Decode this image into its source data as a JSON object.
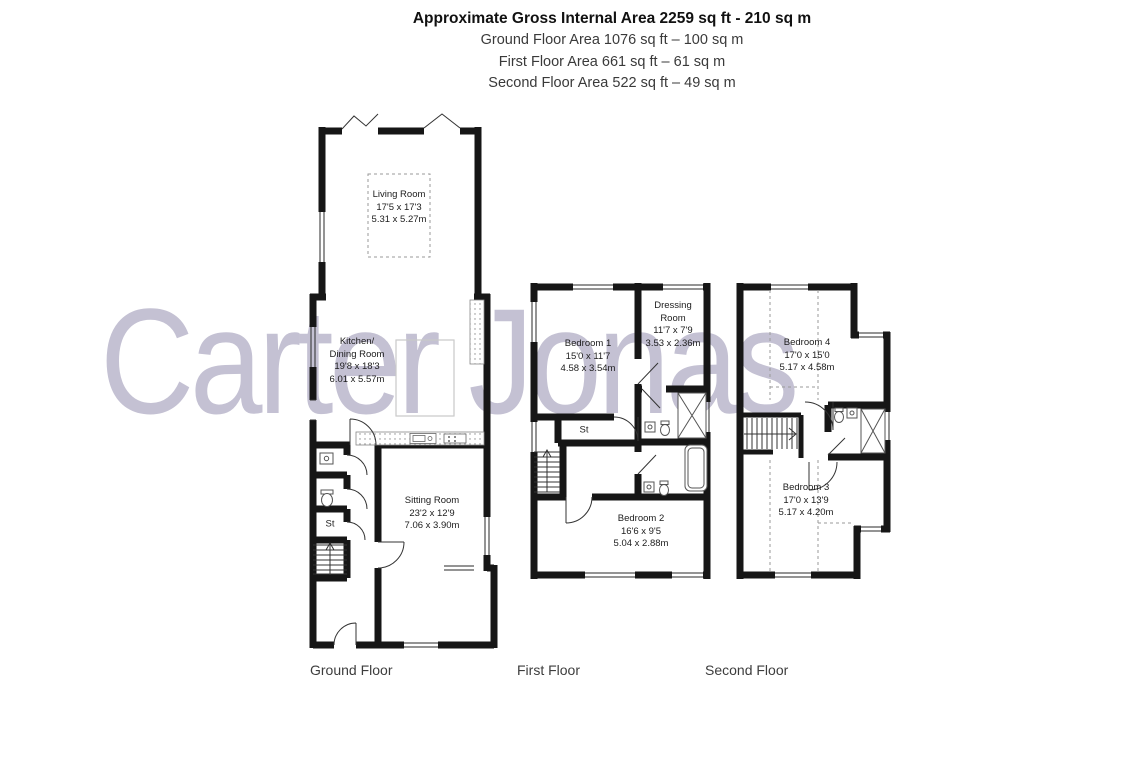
{
  "header": {
    "title": "Approximate Gross Internal Area 2259 sq ft - 210 sq m",
    "ground_line": "Ground Floor Area 1076 sq ft – 100 sq m",
    "first_line": "First Floor Area 661 sq ft – 61 sq m",
    "second_line": "Second Floor Area 522 sq ft – 49 sq m"
  },
  "watermark": {
    "text": "Carter Jonas",
    "color": "#c4c1d3"
  },
  "floors": {
    "ground": {
      "label": "Ground Floor",
      "rooms": {
        "living": {
          "name": "Living Room",
          "imperial": "17'5 x 17'3",
          "metric": "5.31 x 5.27m"
        },
        "kitchen": {
          "name": "Kitchen/",
          "name2": "Dining Room",
          "imperial": "19'8 x 18'3",
          "metric": "6.01 x 5.57m"
        },
        "sitting": {
          "name": "Sitting Room",
          "imperial": "23'2 x 12'9",
          "metric": "7.06 x 3.90m"
        },
        "store": {
          "name": "St"
        }
      }
    },
    "first": {
      "label": "First Floor",
      "rooms": {
        "bedroom1": {
          "name": "Bedroom 1",
          "imperial": "15'0 x 11'7",
          "metric": "4.58 x 3.54m"
        },
        "dressing": {
          "name": "Dressing",
          "name2": "Room",
          "imperial": "11'7 x 7'9",
          "metric": "3.53 x 2.36m"
        },
        "bedroom2": {
          "name": "Bedroom 2",
          "imperial": "16'6 x 9'5",
          "metric": "5.04 x 2.88m"
        },
        "store": {
          "name": "St"
        }
      }
    },
    "second": {
      "label": "Second Floor",
      "rooms": {
        "bedroom4": {
          "name": "Bedroom 4",
          "imperial": "17'0 x 15'0",
          "metric": "5.17 x 4.58m"
        },
        "bedroom3": {
          "name": "Bedroom 3",
          "imperial": "17'0 x 13'9",
          "metric": "5.17 x 4.20m"
        }
      }
    }
  }
}
